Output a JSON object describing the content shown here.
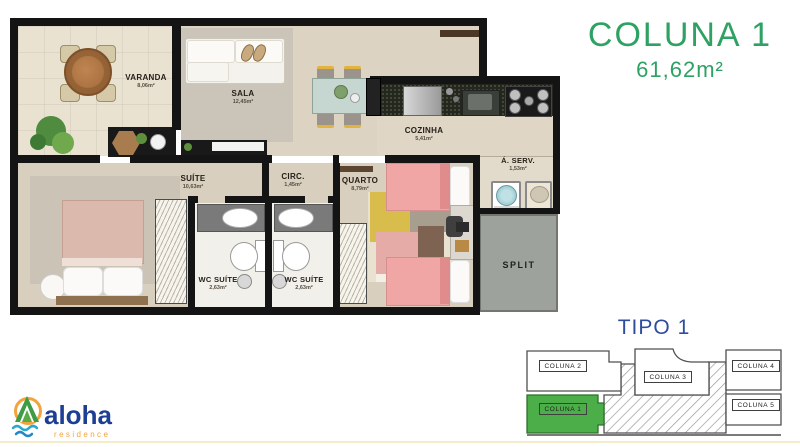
{
  "header": {
    "title": "COLUNA 1",
    "area": "61,62m²"
  },
  "floorplan": {
    "rooms": {
      "varanda": {
        "label": "VARANDA",
        "area": "8,06m²"
      },
      "sala": {
        "label": "SALA",
        "area": "12,45m²"
      },
      "cozinha": {
        "label": "COZINHA",
        "area": "5,41m²"
      },
      "area_servico": {
        "label": "Á. SERV.",
        "area": "1,53m²"
      },
      "suite": {
        "label": "SUÍTE",
        "area": "10,63m²"
      },
      "circulacao": {
        "label": "CIRC.",
        "area": "1,45m²"
      },
      "quarto": {
        "label": "QUARTO",
        "area": "8,79m²"
      },
      "wc_suite_1": {
        "label": "WC SUÍTE",
        "area": "2,63m²"
      },
      "wc_suite_2": {
        "label": "WC SUÍTE",
        "area": "2,63m²"
      },
      "split": {
        "label": "SPLIT"
      }
    }
  },
  "tipo": {
    "title": "TIPO 1",
    "units": [
      {
        "label": "COLUNA 2"
      },
      {
        "label": "COLUNA 3"
      },
      {
        "label": "COLUNA 4"
      },
      {
        "label": "COLUNA 1",
        "highlighted": true
      },
      {
        "label": "COLUNA 5"
      }
    ]
  },
  "logo": {
    "brand": "aloha",
    "subtitle": "residence"
  },
  "colors": {
    "accent_green": "#2EA263",
    "tipo_blue": "#2E4D9E",
    "unit_highlight_green": "#4CAE49",
    "logo_blue": "#1D3F93",
    "logo_orange": "#F2A33C",
    "wall_black": "#141414",
    "floor_beige": "#D8CFBE"
  }
}
